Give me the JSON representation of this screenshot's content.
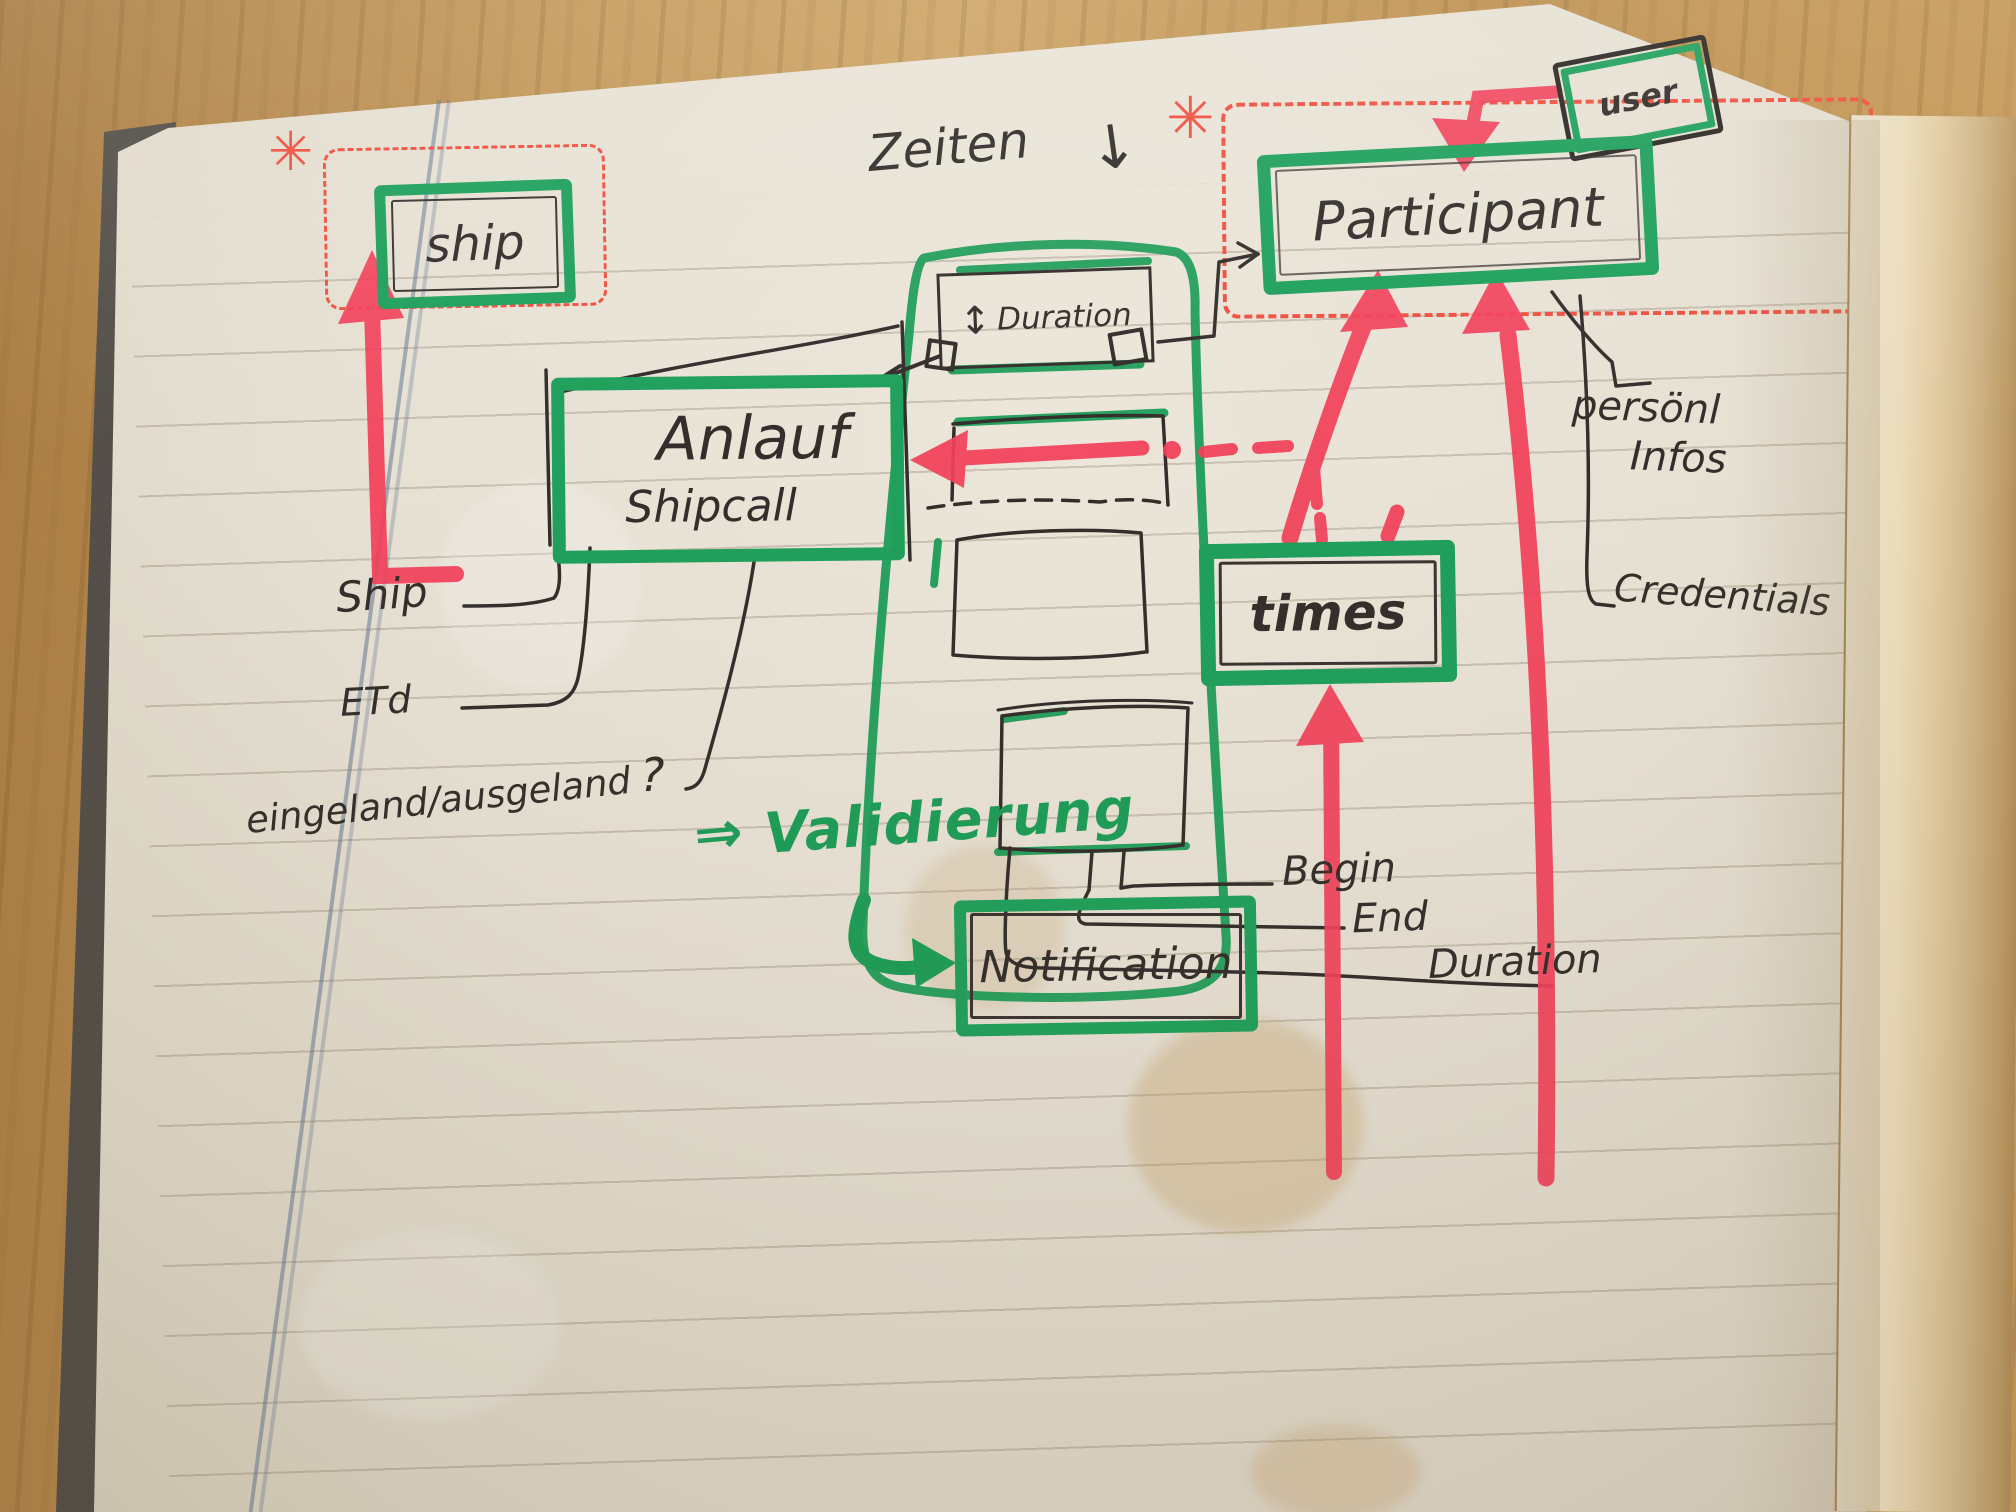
{
  "boxes": {
    "ship": {
      "label": "ship"
    },
    "duration": {
      "label": "Duration",
      "arrow": "↕"
    },
    "user": {
      "label": "user"
    },
    "participant": {
      "label": "Participant"
    },
    "anlauf": {
      "label": "Anlauf",
      "sublabel": "Shipcall"
    },
    "times": {
      "label": "times"
    },
    "notification": {
      "label": "Notification"
    }
  },
  "annotations": {
    "zeiten": "Zeiten",
    "zeiten_arrow": "↓",
    "ship_attr": "Ship",
    "etd_attr": "ETd",
    "inout_attr": "eingeland/ausgeland",
    "inout_q": "?",
    "personl_line1": "persönl",
    "personl_line2": "Infos",
    "credentials_attr": "Credentials",
    "begin_attr": "Begin",
    "end_attr": "End",
    "duration_attr": "Duration",
    "validierung_arrow": "⇒",
    "validierung": "Validierung",
    "asterisk": "✳"
  },
  "colors": {
    "marker_green": "#1fa05c",
    "marker_red": "#f2415a",
    "dashed_red": "#f0503f",
    "pen_black": "#332e2b",
    "paper": "#e9e3d6",
    "wood": "#c59a5b"
  }
}
